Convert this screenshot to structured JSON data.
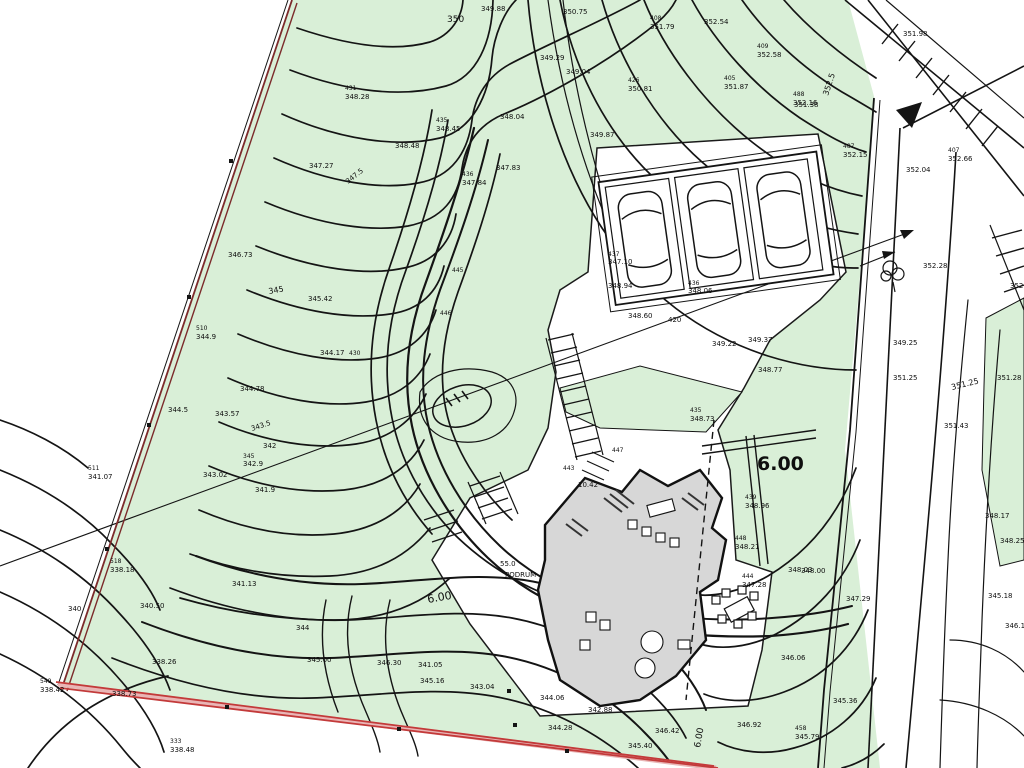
{
  "map": {
    "type": "topographic-site-plan",
    "colors": {
      "parcel-green": "#d9efd7",
      "contour-black": "#141414",
      "boundary-red": "#c33a3a",
      "boundary-red-light": "#e9b6b6",
      "boundary-maroon": "#7c2b2b",
      "building-gray": "#d7d7d7",
      "paper-white": "#ffffff"
    },
    "big_dimension_label": "6.00",
    "basement_label": "PODRUM"
  },
  "labels": [
    {
      "x": 447,
      "y": 22,
      "t": "350",
      "s": 9
    },
    {
      "x": 481,
      "y": 11,
      "t": "349.88"
    },
    {
      "x": 540,
      "y": 60,
      "t": "349.29"
    },
    {
      "x": 566,
      "y": 74,
      "t": "349.04"
    },
    {
      "x": 563,
      "y": 14,
      "t": "350.75"
    },
    {
      "x": 650,
      "y": 20,
      "t": "408",
      "s": 6
    },
    {
      "x": 650,
      "y": 29,
      "t": "351.79"
    },
    {
      "x": 704,
      "y": 24,
      "t": "352.54"
    },
    {
      "x": 757,
      "y": 48,
      "t": "409",
      "s": 6
    },
    {
      "x": 757,
      "y": 57,
      "t": "352.58"
    },
    {
      "x": 724,
      "y": 80,
      "t": "405",
      "s": 6
    },
    {
      "x": 724,
      "y": 89,
      "t": "351.87"
    },
    {
      "x": 794,
      "y": 107,
      "t": "351.38"
    },
    {
      "x": 828,
      "y": 96,
      "t": "352.5",
      "s": 8,
      "r": -72
    },
    {
      "x": 903,
      "y": 36,
      "t": "351.98"
    },
    {
      "x": 793,
      "y": 96,
      "t": "488",
      "s": 6
    },
    {
      "x": 793,
      "y": 105,
      "t": "352.16"
    },
    {
      "x": 843,
      "y": 148,
      "t": "487",
      "s": 6
    },
    {
      "x": 843,
      "y": 157,
      "t": "352.15"
    },
    {
      "x": 948,
      "y": 152,
      "t": "407",
      "s": 6
    },
    {
      "x": 948,
      "y": 161,
      "t": "352.66"
    },
    {
      "x": 906,
      "y": 172,
      "t": "352.04"
    },
    {
      "x": 628,
      "y": 82,
      "t": "426",
      "s": 6
    },
    {
      "x": 628,
      "y": 91,
      "t": "350.81"
    },
    {
      "x": 590,
      "y": 137,
      "t": "349.87"
    },
    {
      "x": 345,
      "y": 90,
      "t": "431",
      "s": 6
    },
    {
      "x": 345,
      "y": 99,
      "t": "348.28"
    },
    {
      "x": 436,
      "y": 122,
      "t": "435",
      "s": 6
    },
    {
      "x": 436,
      "y": 131,
      "t": "348.45"
    },
    {
      "x": 395,
      "y": 148,
      "t": "348.48"
    },
    {
      "x": 500,
      "y": 119,
      "t": "348.04"
    },
    {
      "x": 496,
      "y": 170,
      "t": "347.83"
    },
    {
      "x": 462,
      "y": 176,
      "t": "436",
      "s": 6
    },
    {
      "x": 462,
      "y": 185,
      "t": "347.84"
    },
    {
      "x": 309,
      "y": 168,
      "t": "347.27"
    },
    {
      "x": 348,
      "y": 184,
      "t": "347.5",
      "r": -38
    },
    {
      "x": 228,
      "y": 257,
      "t": "346.73"
    },
    {
      "x": 269,
      "y": 294,
      "t": "345",
      "s": 8,
      "r": -10
    },
    {
      "x": 308,
      "y": 301,
      "t": "345.42"
    },
    {
      "x": 320,
      "y": 355,
      "t": "344.17"
    },
    {
      "x": 349,
      "y": 355,
      "t": "430",
      "s": 6
    },
    {
      "x": 240,
      "y": 391,
      "t": "344.78"
    },
    {
      "x": 196,
      "y": 330,
      "t": "510",
      "s": 6
    },
    {
      "x": 196,
      "y": 339,
      "t": "344.9"
    },
    {
      "x": 215,
      "y": 416,
      "t": "343.57"
    },
    {
      "x": 252,
      "y": 431,
      "t": "343.5",
      "r": -18
    },
    {
      "x": 263,
      "y": 448,
      "t": "342"
    },
    {
      "x": 168,
      "y": 412,
      "t": "344.5"
    },
    {
      "x": 243,
      "y": 458,
      "t": "345",
      "s": 6
    },
    {
      "x": 243,
      "y": 466,
      "t": "342.9"
    },
    {
      "x": 203,
      "y": 477,
      "t": "343.02"
    },
    {
      "x": 88,
      "y": 470,
      "t": "511",
      "s": 6
    },
    {
      "x": 88,
      "y": 479,
      "t": "341.07"
    },
    {
      "x": 255,
      "y": 492,
      "t": "341.9"
    },
    {
      "x": 110,
      "y": 563,
      "t": "518",
      "s": 6
    },
    {
      "x": 110,
      "y": 572,
      "t": "338.18"
    },
    {
      "x": 68,
      "y": 611,
      "t": "340"
    },
    {
      "x": 140,
      "y": 608,
      "t": "340.50"
    },
    {
      "x": 232,
      "y": 586,
      "t": "341.13"
    },
    {
      "x": 40,
      "y": 683,
      "t": "549",
      "s": 6
    },
    {
      "x": 40,
      "y": 692,
      "t": "338.42"
    },
    {
      "x": 112,
      "y": 696,
      "t": "338.73"
    },
    {
      "x": 152,
      "y": 664,
      "t": "338.26"
    },
    {
      "x": 170,
      "y": 743,
      "t": "333",
      "s": 6
    },
    {
      "x": 170,
      "y": 752,
      "t": "338.48"
    },
    {
      "x": 296,
      "y": 630,
      "t": "344"
    },
    {
      "x": 307,
      "y": 662,
      "t": "345.00"
    },
    {
      "x": 377,
      "y": 665,
      "t": "346.30"
    },
    {
      "x": 418,
      "y": 667,
      "t": "341.05"
    },
    {
      "x": 420,
      "y": 683,
      "t": "345.16"
    },
    {
      "x": 470,
      "y": 689,
      "t": "343.04"
    },
    {
      "x": 540,
      "y": 700,
      "t": "344.06"
    },
    {
      "x": 588,
      "y": 712,
      "t": "342.88"
    },
    {
      "x": 548,
      "y": 730,
      "t": "344.28"
    },
    {
      "x": 628,
      "y": 748,
      "t": "345.40"
    },
    {
      "x": 608,
      "y": 256,
      "t": "437",
      "s": 6
    },
    {
      "x": 608,
      "y": 264,
      "t": "347.10"
    },
    {
      "x": 608,
      "y": 288,
      "t": "348.94"
    },
    {
      "x": 688,
      "y": 285,
      "t": "436",
      "s": 6
    },
    {
      "x": 688,
      "y": 293,
      "t": "348.06"
    },
    {
      "x": 668,
      "y": 322,
      "t": "420"
    },
    {
      "x": 628,
      "y": 318,
      "t": "348.60"
    },
    {
      "x": 712,
      "y": 346,
      "t": "349.22"
    },
    {
      "x": 748,
      "y": 342,
      "t": "349.37"
    },
    {
      "x": 758,
      "y": 372,
      "t": "348.77"
    },
    {
      "x": 690,
      "y": 412,
      "t": "435",
      "s": 6
    },
    {
      "x": 690,
      "y": 421,
      "t": "348.73"
    },
    {
      "x": 757,
      "y": 470,
      "t": "6.00",
      "s": 19,
      "b": 1
    },
    {
      "x": 745,
      "y": 499,
      "t": "439",
      "s": 6
    },
    {
      "x": 745,
      "y": 508,
      "t": "348.96"
    },
    {
      "x": 735,
      "y": 540,
      "t": "448",
      "s": 6
    },
    {
      "x": 735,
      "y": 549,
      "t": "348.21"
    },
    {
      "x": 788,
      "y": 572,
      "t": "348.03"
    },
    {
      "x": 742,
      "y": 578,
      "t": "444",
      "s": 6
    },
    {
      "x": 742,
      "y": 587,
      "t": "347.28"
    },
    {
      "x": 801,
      "y": 573,
      "t": "348.00"
    },
    {
      "x": 846,
      "y": 601,
      "t": "347.29"
    },
    {
      "x": 781,
      "y": 660,
      "t": "346.06"
    },
    {
      "x": 833,
      "y": 703,
      "t": "345.36"
    },
    {
      "x": 737,
      "y": 727,
      "t": "346.92"
    },
    {
      "x": 795,
      "y": 730,
      "t": "458",
      "s": 6
    },
    {
      "x": 795,
      "y": 739,
      "t": "345.79"
    },
    {
      "x": 655,
      "y": 733,
      "t": "346.42"
    },
    {
      "x": 923,
      "y": 268,
      "t": "352.28"
    },
    {
      "x": 1010,
      "y": 288,
      "t": "352.5"
    },
    {
      "x": 893,
      "y": 380,
      "t": "351.25"
    },
    {
      "x": 952,
      "y": 390,
      "t": "351.25",
      "s": 8,
      "r": -14
    },
    {
      "x": 997,
      "y": 380,
      "t": "351.28"
    },
    {
      "x": 944,
      "y": 428,
      "t": "351.43"
    },
    {
      "x": 893,
      "y": 345,
      "t": "349.25"
    },
    {
      "x": 985,
      "y": 518,
      "t": "348.17"
    },
    {
      "x": 1000,
      "y": 543,
      "t": "348.25"
    },
    {
      "x": 988,
      "y": 598,
      "t": "345.18"
    },
    {
      "x": 1005,
      "y": 628,
      "t": "346.10"
    },
    {
      "x": 500,
      "y": 566,
      "t": "55.0"
    },
    {
      "x": 505,
      "y": 577,
      "t": "PODRUM"
    },
    {
      "x": 578,
      "y": 487,
      "t": "10.42"
    },
    {
      "x": 563,
      "y": 470,
      "t": "443",
      "s": 6
    },
    {
      "x": 612,
      "y": 452,
      "t": "447",
      "s": 6
    },
    {
      "x": 428,
      "y": 603,
      "t": "6.00",
      "s": 11,
      "r": -10
    },
    {
      "x": 700,
      "y": 748,
      "t": "6.00",
      "s": 9,
      "r": -80
    },
    {
      "x": 452,
      "y": 272,
      "t": "445",
      "s": 6
    },
    {
      "x": 440,
      "y": 315,
      "t": "446",
      "s": 6
    }
  ]
}
